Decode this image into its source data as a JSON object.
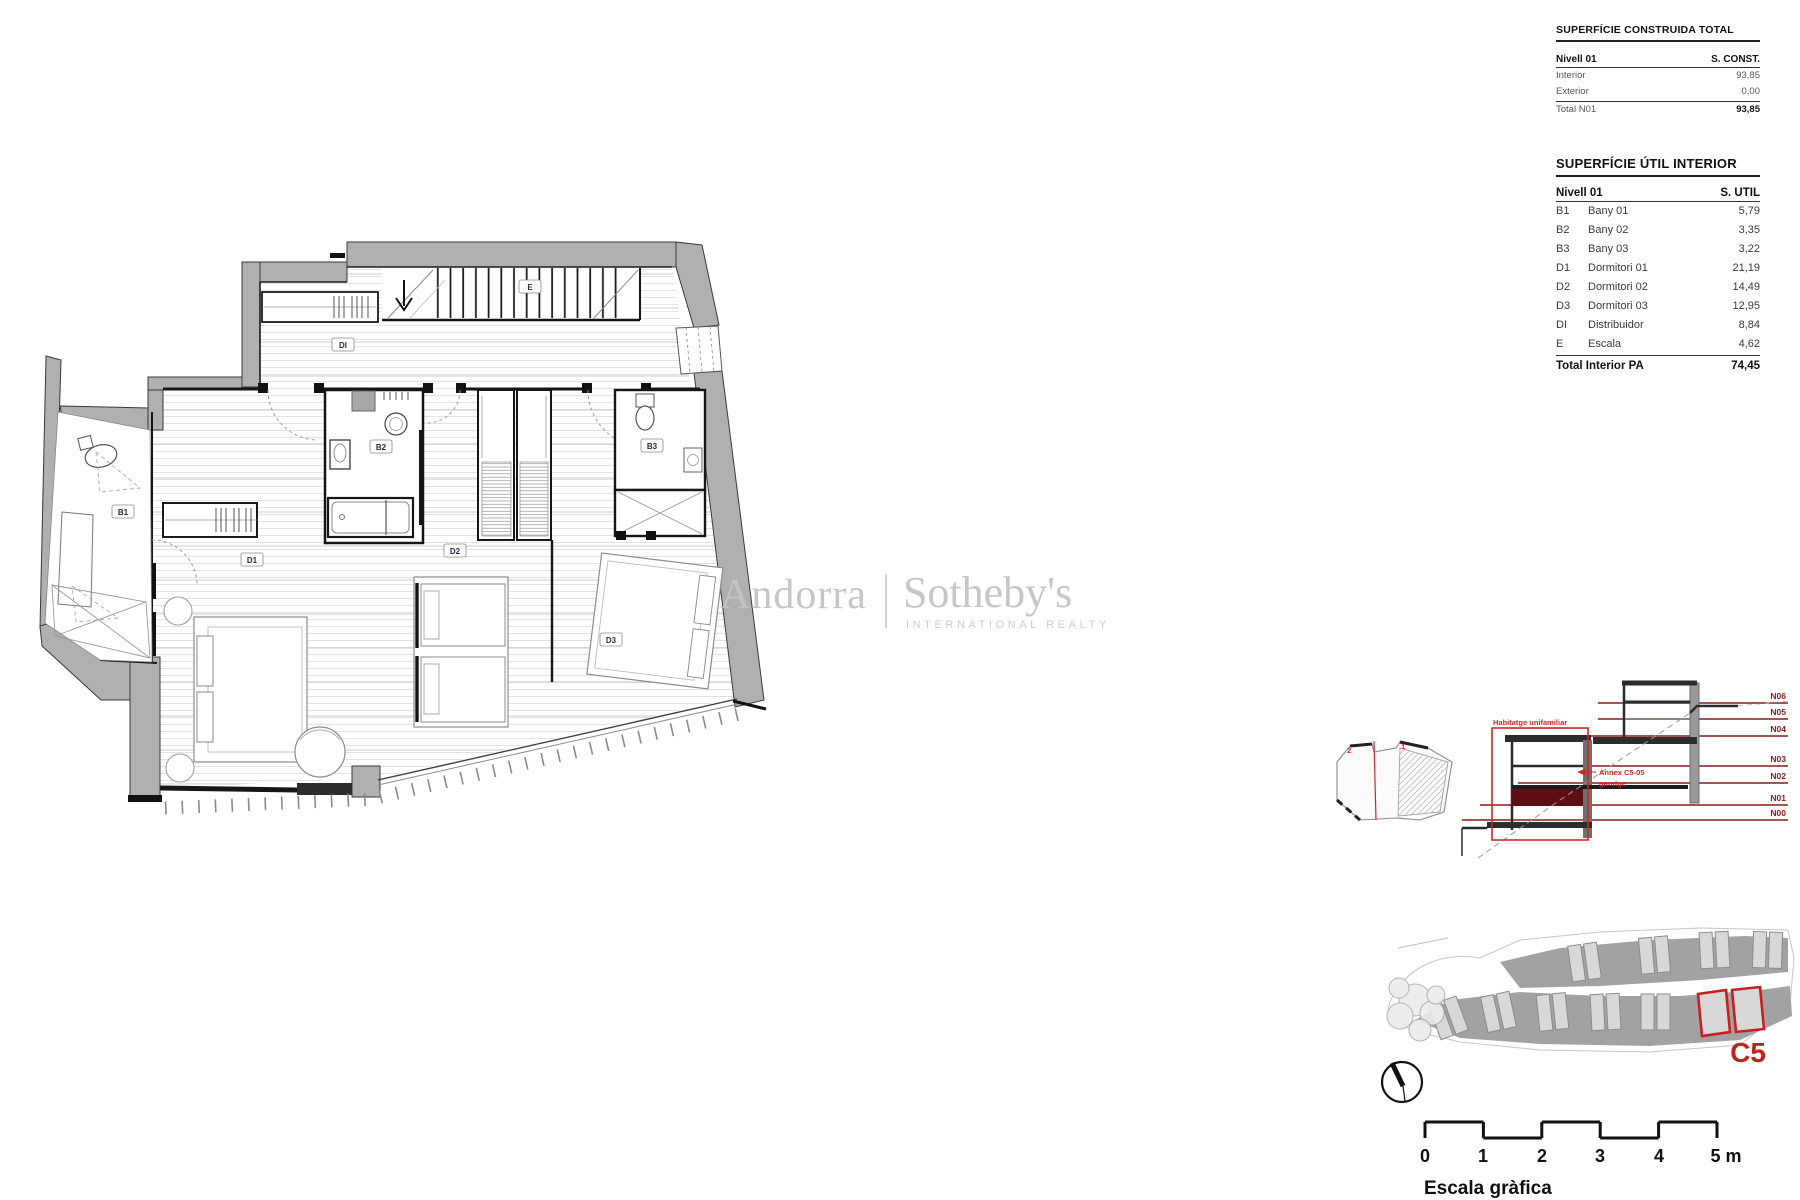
{
  "watermark": {
    "brand": "Andorra",
    "name": "Sotheby's",
    "subtitle": "INTERNATIONAL REALTY"
  },
  "tables": {
    "construida": {
      "title": "SUPERFÍCIE CONSTRUIDA TOTAL",
      "header": {
        "col1": "Nivell 01",
        "col2": "S. CONST."
      },
      "rows": [
        {
          "label": "Interior",
          "value": "93,85"
        },
        {
          "label": "Exterior",
          "value": "0,00"
        }
      ],
      "total": {
        "label": "Total N01",
        "value": "93,85"
      }
    },
    "util": {
      "title": "SUPERFÍCIE ÚTIL INTERIOR",
      "header": {
        "col1": "Nivell 01",
        "col2": "S. UTIL"
      },
      "rows": [
        {
          "code": "B1",
          "name": "Bany 01",
          "value": "5,79"
        },
        {
          "code": "B2",
          "name": "Bany 02",
          "value": "3,35"
        },
        {
          "code": "B3",
          "name": "Bany 03",
          "value": "3,22"
        },
        {
          "code": "D1",
          "name": "Dormitori 01",
          "value": "21,19"
        },
        {
          "code": "D2",
          "name": "Dormitori 02",
          "value": "14,49"
        },
        {
          "code": "D3",
          "name": "Dormitori 03",
          "value": "12,95"
        },
        {
          "code": "DI",
          "name": "Distribuidor",
          "value": "8,84"
        },
        {
          "code": "E",
          "name": "Escala",
          "value": "4,62"
        }
      ],
      "total": {
        "label": "Total Interior PA",
        "value": "74,45"
      }
    }
  },
  "floorplan": {
    "labels": [
      {
        "code": "E"
      },
      {
        "code": "DI"
      },
      {
        "code": "B1"
      },
      {
        "code": "B2"
      },
      {
        "code": "B3"
      },
      {
        "code": "D1"
      },
      {
        "code": "D2"
      },
      {
        "code": "D3"
      }
    ]
  },
  "section": {
    "levels": [
      "N06",
      "N05",
      "N04",
      "N03",
      "N02",
      "N01",
      "N00"
    ],
    "house_label": "Habitatge unifamiliar",
    "annex_line1": "Annex C5-05",
    "annex_line2": "garatge",
    "cut_marks": [
      "2",
      "1"
    ]
  },
  "siteplan": {
    "unit_label": "C5"
  },
  "scalebar": {
    "ticks": [
      "0",
      "1",
      "2",
      "3",
      "4",
      "5 m"
    ],
    "caption": "Escala gràfica"
  },
  "colors": {
    "wall_gray": "#b0b0b0",
    "accent_red": "#cf2626",
    "level_red": "#8b1a1a",
    "slab_maroon": "#5e0d12",
    "watermark_gray": "#c4c4c4"
  }
}
